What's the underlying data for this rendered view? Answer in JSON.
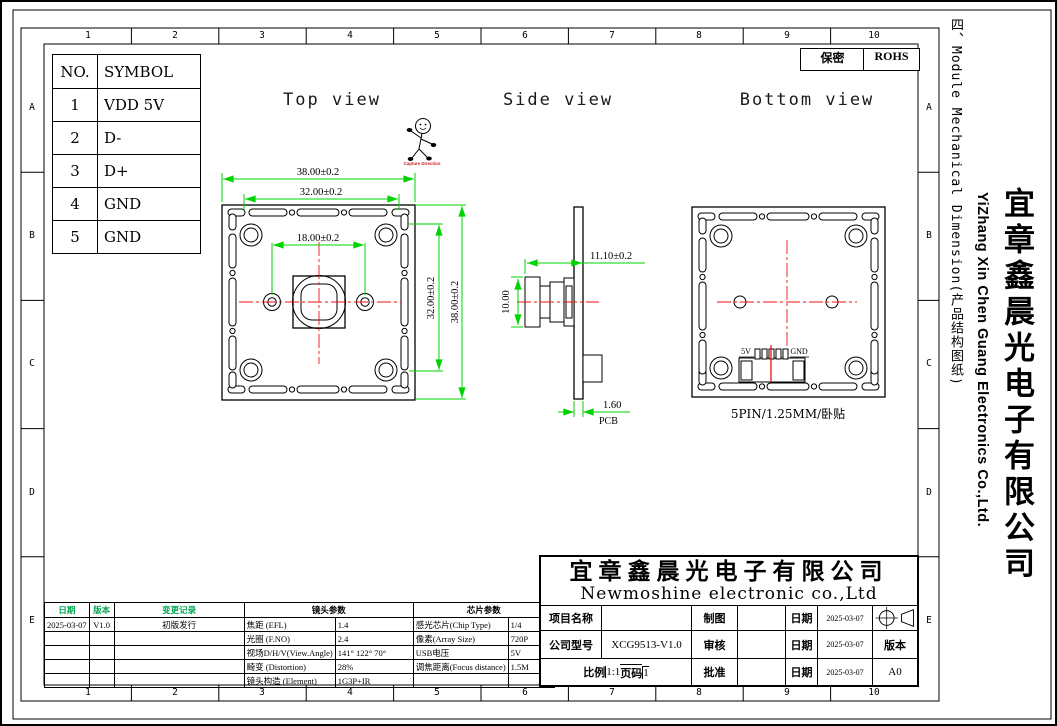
{
  "grid_refs": {
    "columns": [
      "1",
      "2",
      "3",
      "4",
      "5",
      "6",
      "7",
      "8",
      "9",
      "10"
    ],
    "rows": [
      "A",
      "B",
      "C",
      "D",
      "E"
    ]
  },
  "header": {
    "confidential_label": "保密",
    "rohs_label": "ROHS"
  },
  "side_panel": {
    "section_title": "四、Module Mechanical Dimension(产品结构图纸)",
    "company_cn": "宜章鑫晨光电子有限公司",
    "company_en": "YiZhang Xin Chen Guang Electronics Co.,Ltd."
  },
  "pin_table": {
    "headers": [
      "NO.",
      "SYMBOL"
    ],
    "rows": [
      [
        "1",
        "VDD 5V"
      ],
      [
        "2",
        "D-"
      ],
      [
        "3",
        "D+"
      ],
      [
        "4",
        "GND"
      ],
      [
        "5",
        "GND"
      ]
    ]
  },
  "views": {
    "capture_direction_label": "Capture Direction",
    "top": {
      "title": "Top view",
      "dim_width_outer": "38.00±0.2",
      "dim_width_inner": "32.00±0.2",
      "dim_hole_pitch": "18.00±0.2",
      "dim_height_inner": "32.00±0.2",
      "dim_height_outer": "38.00±0.2"
    },
    "side": {
      "title": "Side view",
      "dim_total_depth": "11.10±0.2",
      "dim_lens_height": "10.00",
      "dim_pcb_thickness": "1.60",
      "pcb_label": "PCB"
    },
    "bottom": {
      "title": "Bottom view",
      "pin_left_label": "5V",
      "pin_right_label": "GND",
      "connector_note": "5PIN/1.25MM/卧贴"
    }
  },
  "revision_table": {
    "date_header": "日期",
    "version_header": "版本",
    "record_header": "变更记录",
    "rows": [
      {
        "date": "2025-03-07",
        "version": "V1.0",
        "record": "初版发行"
      }
    ]
  },
  "lens_params": {
    "header": "镜头参数",
    "rows": [
      [
        "焦距 (EFL)",
        "1.4"
      ],
      [
        "光圈 (F.NO)",
        "2.4"
      ],
      [
        "视场D/H/V(View.Angle)",
        "141° 122° 70°"
      ],
      [
        "畸变 (Distortion)",
        "28%"
      ],
      [
        "镜头构造 (Element)",
        "1G3P+IR"
      ]
    ]
  },
  "chip_params": {
    "header": "芯片参数",
    "rows": [
      [
        "感光芯片(Chip Type)",
        "1/4"
      ],
      [
        "像素(Array Size)",
        "720P"
      ],
      [
        "USB电压",
        "5V"
      ],
      [
        "调焦距离(Focus distance)",
        "1.5M"
      ],
      [
        "",
        ""
      ]
    ]
  },
  "title_block": {
    "company_cn": "宜章鑫晨光电子有限公司",
    "company_en": "Newmoshine electronic co.,Ltd",
    "project_label": "项目名称",
    "project_value": "",
    "model_label": "公司型号",
    "model_value": "XCG9513-V1.0",
    "scale_label": "比例",
    "scale_value": "1:1",
    "page_label": "页码",
    "page_value": "1",
    "drawn_label": "制图",
    "checked_label": "审核",
    "approved_label": "批准",
    "date_label1": "日期",
    "date_label2": "日期",
    "date_label3": "日期",
    "date1": "2025-03-07",
    "date2": "2025-03-07",
    "date3": "2025-03-07",
    "version_label": "版本",
    "version_value": "A0"
  },
  "colors": {
    "dimension_green": "#00d400",
    "table_header_green": "#00a651",
    "centerline_red": "#f11212",
    "capture_red": "#cc2222"
  }
}
